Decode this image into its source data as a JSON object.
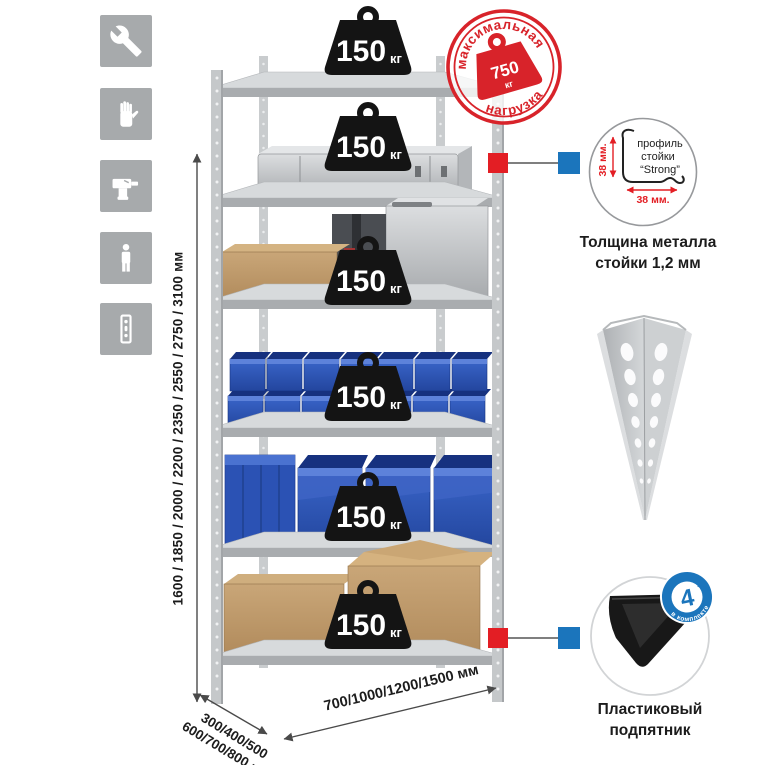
{
  "colors": {
    "accent_red": "#e31e24",
    "stamp_red": "#d8232a",
    "callout_blue": "#1b75bc",
    "bin_blue": "#2f5cc0",
    "icon_gray": "#a7aaac"
  },
  "feature_icons": [
    {
      "name": "wrench-icon"
    },
    {
      "name": "gloves-icon"
    },
    {
      "name": "drill-icon"
    },
    {
      "name": "person-icon"
    },
    {
      "name": "rack-post-icon"
    }
  ],
  "dimensions": {
    "height_label": "1600 / 1850 / 2000 / 2200 / 2350 / 2550 / 2750 / 3100 мм",
    "depth_line1": "300/400/500",
    "depth_line2": "600/700/800 мм",
    "width_label": "700/1000/1200/1500 мм"
  },
  "max_load_stamp": {
    "arc_top": "максимальная",
    "arc_bottom": "нагрузка",
    "value": "750",
    "unit": "кг"
  },
  "shelves": [
    {
      "load": "150",
      "unit": "кг"
    },
    {
      "load": "150",
      "unit": "кг"
    },
    {
      "load": "150",
      "unit": "кг"
    },
    {
      "load": "150",
      "unit": "кг"
    },
    {
      "load": "150",
      "unit": "кг"
    },
    {
      "load": "150",
      "unit": "кг"
    }
  ],
  "profile_callout": {
    "line1": "профиль",
    "line2": "стойки",
    "line3": "“Strong”",
    "vertical_dim": "38 мм.",
    "horizontal_dim": "38 мм.",
    "caption_line1": "Толщина металла",
    "caption_line2": "стойки 1,2 мм"
  },
  "foot_callout": {
    "badge_value": "4",
    "badge_word": "штуки",
    "badge_ring_text": "в комплекте",
    "caption_line1": "Пластиковый",
    "caption_line2": "подпятник"
  }
}
